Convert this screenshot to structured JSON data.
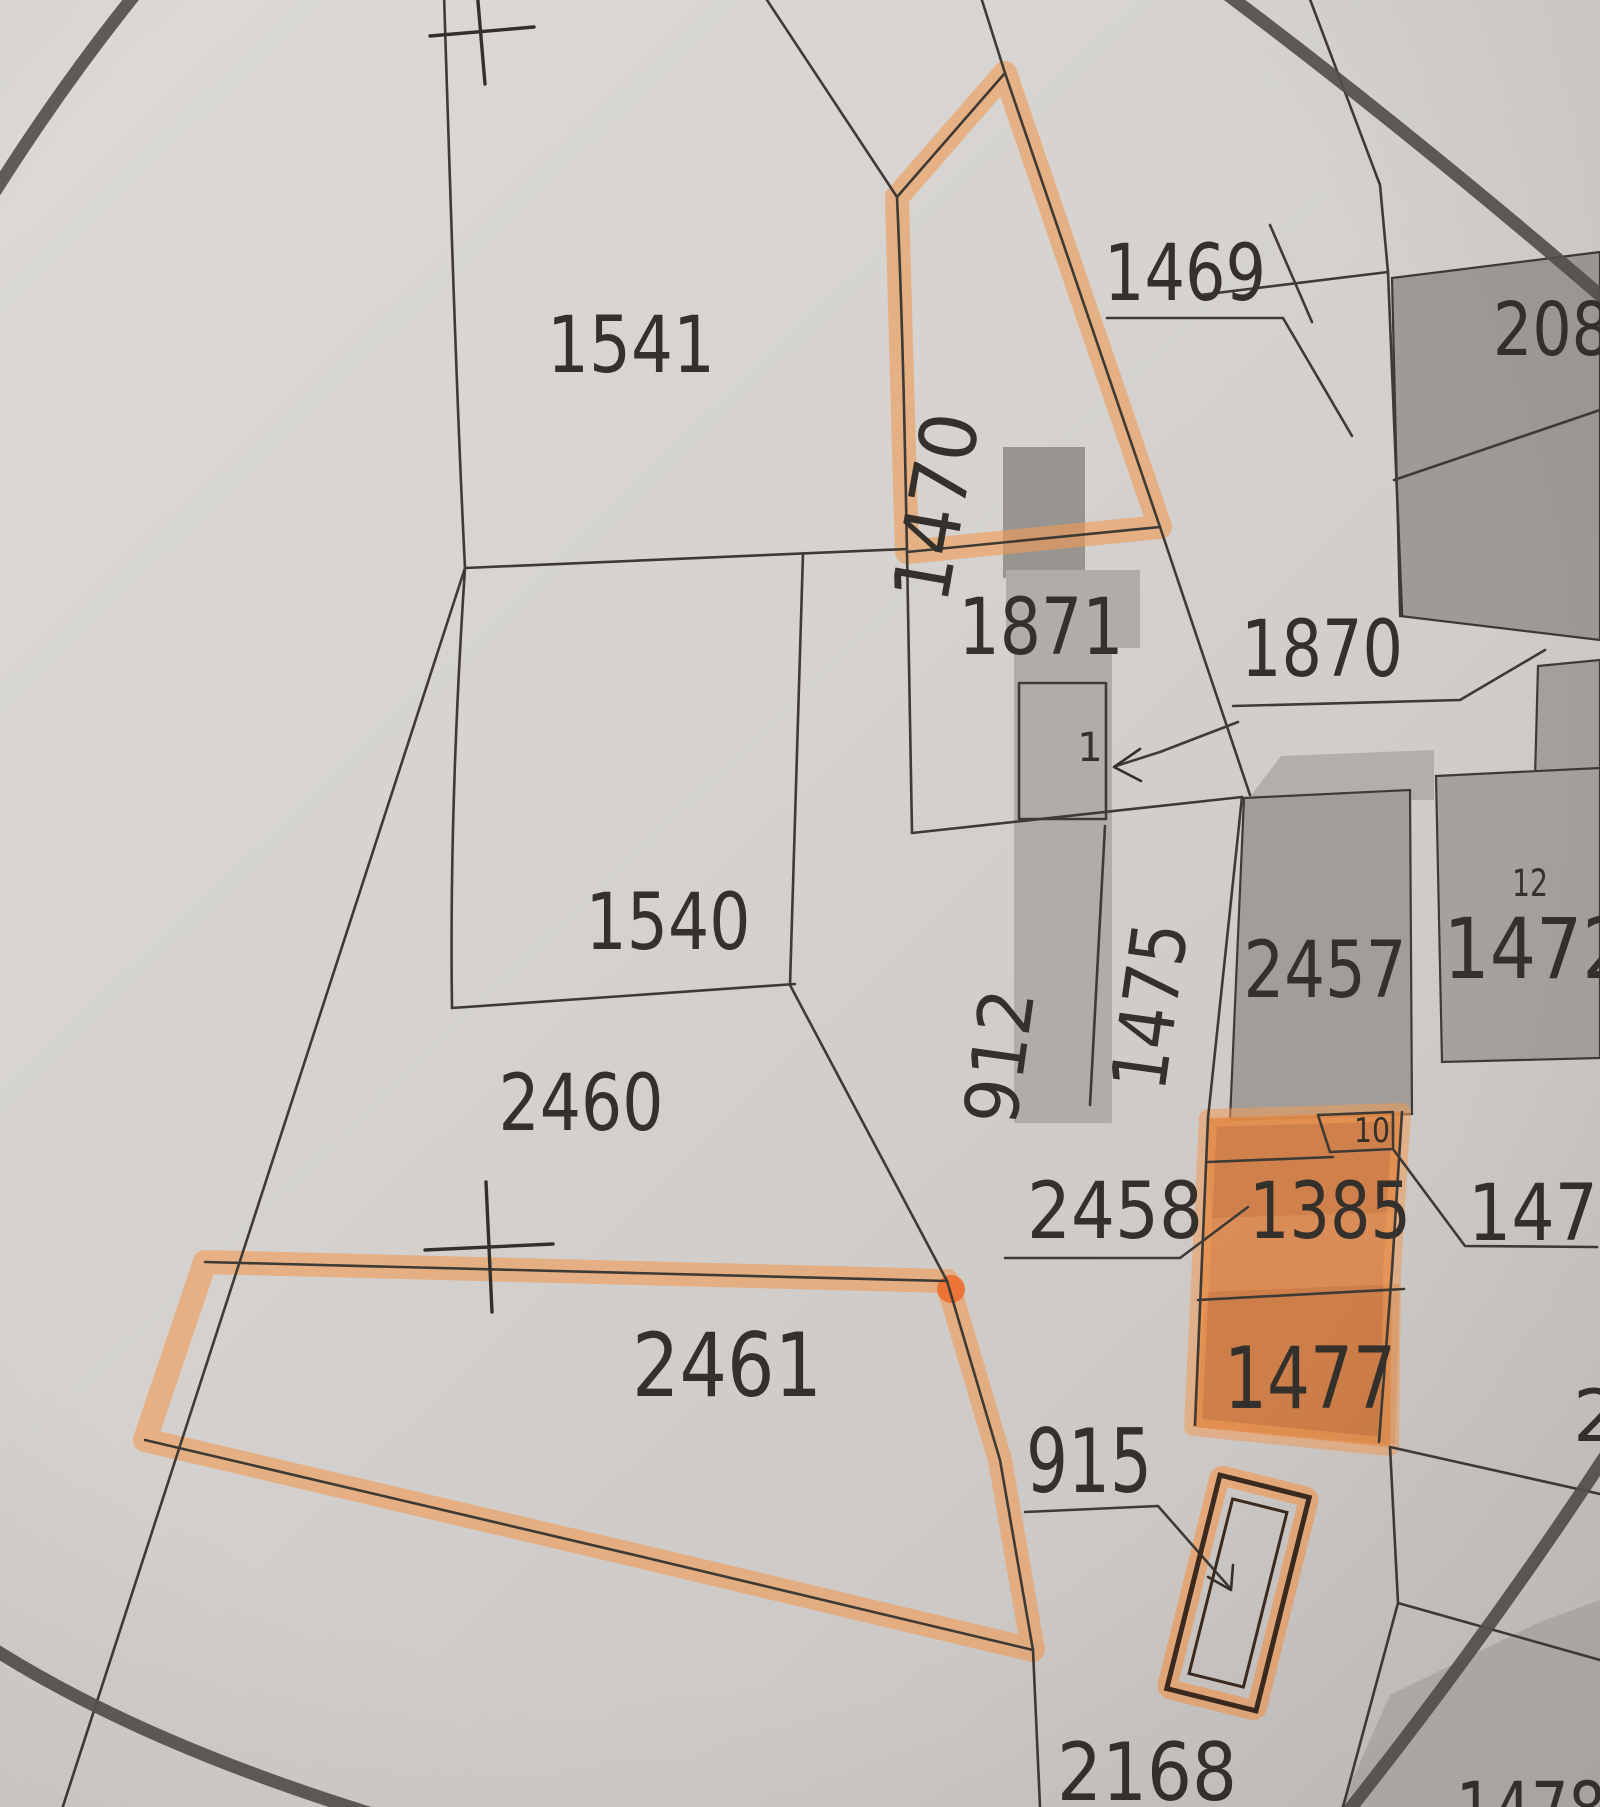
{
  "map": {
    "type": "cadastral-parcel-map-photo",
    "paper_color": "#d5d2cf",
    "line_color": "#3e3a36",
    "label_color": "#34302c",
    "selection_circle_color": "#56514d",
    "building_gray": "#a19d9a",
    "highlighter_orange": "#f19b57",
    "highlighter_fill_orange": "#dd7d3a",
    "highlighted_parcel_outlines": [
      "1470",
      "2461"
    ],
    "highlighted_parcel_fills": [
      "1385",
      "1477",
      "10"
    ],
    "survey_cross_count": 2,
    "labels": [
      {
        "text": "1541",
        "x": 631,
        "y": 372,
        "size": 78,
        "len": 168,
        "rot": 0
      },
      {
        "text": "1469",
        "x": 1185,
        "y": 300,
        "size": 78,
        "len": 162,
        "rot": 0
      },
      {
        "text": "1470",
        "x": 963,
        "y": 512,
        "size": 78,
        "len": 190,
        "rot": -80
      },
      {
        "text": "208",
        "x": 1552,
        "y": 355,
        "size": 74,
        "len": 118,
        "rot": 0
      },
      {
        "text": "1871",
        "x": 1041,
        "y": 654,
        "size": 78,
        "len": 165,
        "rot": 0
      },
      {
        "text": "1870",
        "x": 1322,
        "y": 676,
        "size": 78,
        "len": 162,
        "rot": 0
      },
      {
        "text": "1",
        "x": 1090,
        "y": 761,
        "size": 40,
        "len": 14,
        "rot": 0
      },
      {
        "text": "1540",
        "x": 668,
        "y": 949,
        "size": 78,
        "len": 165,
        "rot": 0
      },
      {
        "text": "912",
        "x": 1025,
        "y": 1060,
        "size": 74,
        "len": 135,
        "rot": -82
      },
      {
        "text": "1475",
        "x": 1176,
        "y": 1010,
        "size": 76,
        "len": 168,
        "rot": -82
      },
      {
        "text": "2457",
        "x": 1325,
        "y": 997,
        "size": 78,
        "len": 163,
        "rot": 0
      },
      {
        "text": "12",
        "x": 1530,
        "y": 896,
        "size": 37,
        "len": 36,
        "rot": 0
      },
      {
        "text": "1472",
        "x": 1536,
        "y": 978,
        "size": 84,
        "len": 185,
        "rot": 0
      },
      {
        "text": "2460",
        "x": 581,
        "y": 1130,
        "size": 78,
        "len": 165,
        "rot": 0
      },
      {
        "text": "2458",
        "x": 1115,
        "y": 1238,
        "size": 78,
        "len": 176,
        "rot": 0
      },
      {
        "text": "1385",
        "x": 1330,
        "y": 1238,
        "size": 78,
        "len": 162,
        "rot": 0
      },
      {
        "text": "10",
        "x": 1372,
        "y": 1142,
        "size": 34,
        "len": 36,
        "rot": 0
      },
      {
        "text": "147",
        "x": 1533,
        "y": 1240,
        "size": 78,
        "len": 130,
        "rot": 0
      },
      {
        "text": "2461",
        "x": 727,
        "y": 1396,
        "size": 88,
        "len": 190,
        "rot": 0
      },
      {
        "text": "1477",
        "x": 1310,
        "y": 1408,
        "size": 86,
        "len": 172,
        "rot": 0
      },
      {
        "text": "915",
        "x": 1089,
        "y": 1492,
        "size": 88,
        "len": 126,
        "rot": 0
      },
      {
        "text": "2",
        "x": 1596,
        "y": 1441,
        "size": 72,
        "len": 40,
        "rot": 0
      },
      {
        "text": "2168",
        "x": 1147,
        "y": 1800,
        "size": 80,
        "len": 180,
        "rot": 0
      },
      {
        "text": "1478",
        "x": 1531,
        "y": 1836,
        "size": 76,
        "len": 150,
        "rot": 0
      }
    ]
  }
}
